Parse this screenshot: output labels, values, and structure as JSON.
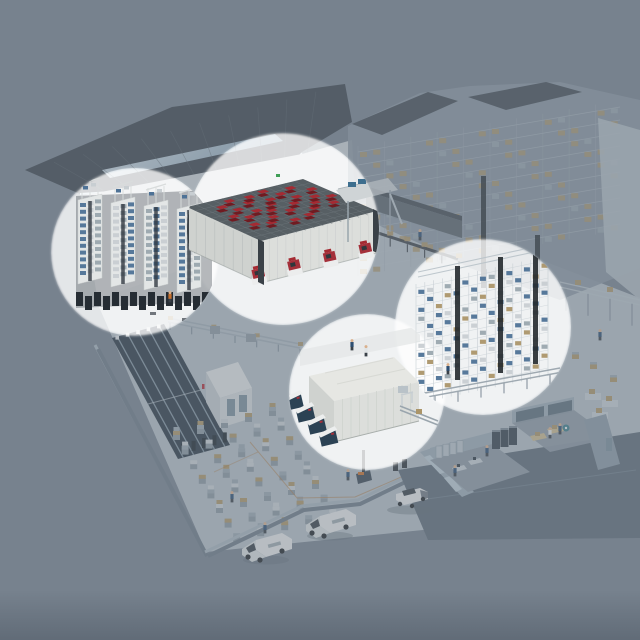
{
  "meta": {
    "type": "isometric-3d-illustration",
    "subject": "automated warehouse logistics facility with four circular highlight zones",
    "canvas_w": 640,
    "canvas_h": 640
  },
  "colors": {
    "bg": "#77828E",
    "tint": "#77828E",
    "highlight": "#FFFFFF",
    "roof_dark": "#3D454D",
    "roof_seam": "#59636B",
    "roof_trim": "#CFDDE6",
    "facade": "#C9D0D4",
    "floor": "#B4BEC5",
    "wall_face": "#6E7B87",
    "wall_top": "#A7B3BC",
    "highbay_body": "#8A96A1",
    "highbay_line": "#B9C2CA",
    "highbay_post": "#9FA9B2",
    "highbay_roof": "#454E56",
    "corridor_top": "#454E55",
    "corridor_face": "#5B646C",
    "right_wall": "#B2BCC3",
    "box_tan": "#AB9569",
    "box_gray": "#9AA6AE",
    "box_light": "#C8CED2",
    "navy_block": "#2D3A46",
    "aisle_line": "#96A8B4",
    "annex_top": "#DFE2E2",
    "annex_left": "#C3C9CC",
    "annex_right": "#D2D6D8",
    "door": "#7C8E9A",
    "grid_top": "#575F64",
    "grid_line": "#6E777C",
    "robot_red": "#A52A32",
    "robot_shadow": "#701B21",
    "port_red": "#A4303A",
    "asrs_frame": "#D9DCDC",
    "asrs_face": "#E3E6E6",
    "asrs_slot": "#323A42",
    "asrs_base": "#262D34",
    "tote_blue": "#4E7296",
    "steel_light": "#C8D0D5",
    "mast_dark": "#23292E",
    "machine_body": "#2B4254",
    "machine_top": "#ECEEEE",
    "room_roof": "#E6E7E3",
    "room_left": "#CFD2CF",
    "room_right": "#DCDEDB",
    "pillar_dark": "#3A4147",
    "mezz": "#CFD4D6",
    "mezz_shelf": "#3D6E8E",
    "office_floor": "#5E6B77",
    "office_room_floor": "#8D99A3",
    "office_wall": "#9DABB5",
    "office_window": "#BAC9D2",
    "office_glass": "#5D6E7B",
    "server_dark": "#39444D",
    "locker": "#B9C3CA",
    "table_tan": "#C9B98F",
    "desk_light": "#C4CDD2",
    "teal_accent": "#3E7D8A",
    "vehicle_body": "#E4E6E6",
    "vehicle_glass": "#3A4248",
    "wheel": "#23272B",
    "person_blue": "#2E4F72",
    "person_white": "#DFE3E5",
    "person_orange": "#C8702D",
    "skin": "#D9B08D",
    "green_sign": "#3F9E56",
    "orange_line": "#B07840",
    "skylight_hi": "#DFEAF1",
    "skylight_lo": "#8FA8BA"
  },
  "highlights": [
    {
      "id": "asrs",
      "label": "miniload tote storage racks"
    },
    {
      "id": "cube",
      "label": "robotic cube storage grid with red robots"
    },
    {
      "id": "shuttle",
      "label": "shuttle rack tote storage"
    },
    {
      "id": "machine",
      "label": "automated packing machine room"
    }
  ],
  "zones": {
    "cube_storage": {
      "name": "robotic cube storage grid",
      "ports": 4,
      "robots": [
        [
          0.05,
          0.45
        ],
        [
          0.07,
          0.75
        ],
        [
          0.1,
          0.18
        ],
        [
          0.14,
          0.55
        ],
        [
          0.17,
          0.32
        ],
        [
          0.2,
          0.8
        ],
        [
          0.23,
          0.08
        ],
        [
          0.27,
          0.45
        ],
        [
          0.29,
          0.68
        ],
        [
          0.33,
          0.22
        ],
        [
          0.37,
          0.52
        ],
        [
          0.39,
          0.86
        ],
        [
          0.41,
          0.1
        ],
        [
          0.45,
          0.38
        ],
        [
          0.49,
          0.62
        ],
        [
          0.51,
          0.27
        ],
        [
          0.55,
          0.82
        ],
        [
          0.57,
          0.05
        ],
        [
          0.61,
          0.48
        ],
        [
          0.65,
          0.2
        ],
        [
          0.67,
          0.7
        ],
        [
          0.71,
          0.35
        ],
        [
          0.75,
          0.58
        ],
        [
          0.79,
          0.12
        ],
        [
          0.83,
          0.44
        ],
        [
          0.87,
          0.68
        ],
        [
          0.91,
          0.26
        ],
        [
          0.94,
          0.52
        ]
      ]
    },
    "asrs": {
      "name": "miniload storage racks",
      "modules": 4,
      "rows": 11
    },
    "shuttle": {
      "name": "shuttle rack storage",
      "cols": 15,
      "rows": 12,
      "masts": 3
    },
    "machine_room": {
      "name": "packing machine room",
      "machines": 4
    },
    "highbay": {
      "name": "high-bay rack warehouse",
      "rows": 10,
      "cols": 20
    },
    "navy_block": {
      "name": "aisle storage block",
      "aisles": 5
    },
    "pallet_area": {
      "name": "pallet rack staging rows",
      "rows": 5,
      "stacks": 8
    },
    "office": {
      "name": "office cutaway",
      "rooms": 2,
      "servers": 3,
      "lockers": 4
    }
  },
  "people": [
    {
      "x": 232,
      "y": 492,
      "c": "blue",
      "layer": "base"
    },
    {
      "x": 265,
      "y": 523,
      "c": "blue",
      "layer": "base"
    },
    {
      "x": 487,
      "y": 446,
      "c": "blue",
      "layer": "base"
    },
    {
      "x": 550,
      "y": 428,
      "c": "white",
      "layer": "base"
    },
    {
      "x": 560,
      "y": 424,
      "c": "blue",
      "layer": "base"
    },
    {
      "x": 455,
      "y": 466,
      "c": "blue",
      "layer": "base"
    },
    {
      "x": 348,
      "y": 470,
      "c": "blue",
      "layer": "base"
    },
    {
      "x": 420,
      "y": 230,
      "c": "blue",
      "layer": "base"
    },
    {
      "x": 600,
      "y": 330,
      "c": "blue",
      "layer": "base"
    },
    {
      "x": 170,
      "y": 292,
      "c": "orange",
      "layer": "left"
    },
    {
      "x": 448,
      "y": 364,
      "c": "blue",
      "layer": "right"
    },
    {
      "x": 352,
      "y": 340,
      "c": "blue",
      "layer": "bottom"
    },
    {
      "x": 366,
      "y": 346,
      "c": "white",
      "layer": "bottom"
    },
    {
      "x": 297,
      "y": 436,
      "c": "white",
      "layer": "bottom"
    }
  ],
  "vehicles": [
    {
      "type": "van",
      "x": 252,
      "y": 548
    },
    {
      "type": "van",
      "x": 316,
      "y": 524
    },
    {
      "type": "car",
      "x": 396,
      "y": 498
    }
  ]
}
